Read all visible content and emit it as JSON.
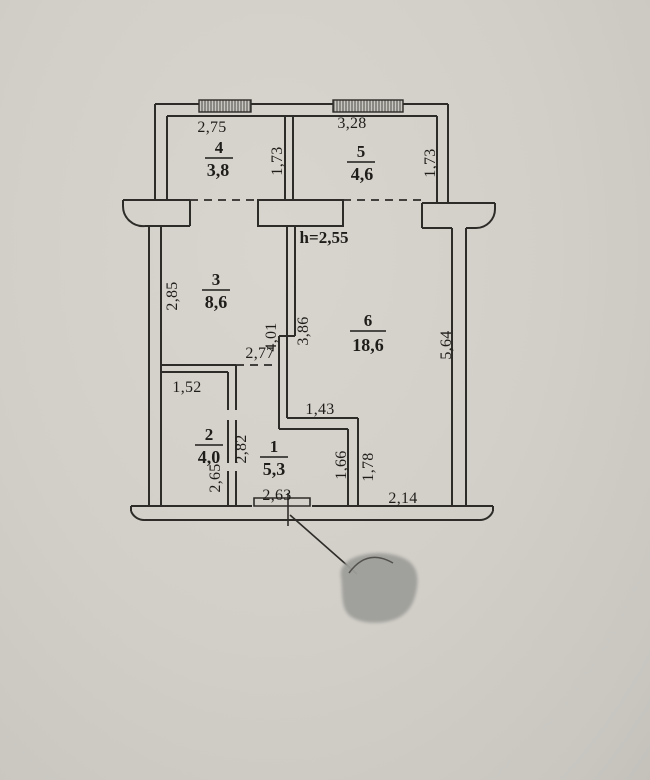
{
  "palette": {
    "paper": "#d2cfc8",
    "paper_edge": "#c3c1ba",
    "ink": "#2e2c29",
    "text": "#1f1d1a",
    "stamp_blob": "#9e9e9a"
  },
  "plan": {
    "height_note": "h=2,55",
    "rooms": [
      {
        "id": "4",
        "area": "3,8"
      },
      {
        "id": "5",
        "area": "4,6"
      },
      {
        "id": "3",
        "area": "8,6"
      },
      {
        "id": "6",
        "area": "18,6"
      },
      {
        "id": "2",
        "area": "4,0"
      },
      {
        "id": "1",
        "area": "5,3"
      }
    ],
    "dimensions": {
      "balcony4_width": "2,75",
      "balcony5_width": "3,28",
      "balcony4_depth": "1,73",
      "balcony5_depth": "1,73",
      "room3_left": "2,85",
      "room3_bottom": "2,77",
      "partition_west": "4,01",
      "partition_east": "3,86",
      "room6_right": "5,64",
      "room2_top": "1,52",
      "hall_west": "2,82",
      "room2_right": "2,65",
      "notch_top": "1,43",
      "notch_west": "1,66",
      "notch_east": "1,78",
      "hall_bottom": "2,63",
      "room6_bottom": "2,14"
    }
  }
}
